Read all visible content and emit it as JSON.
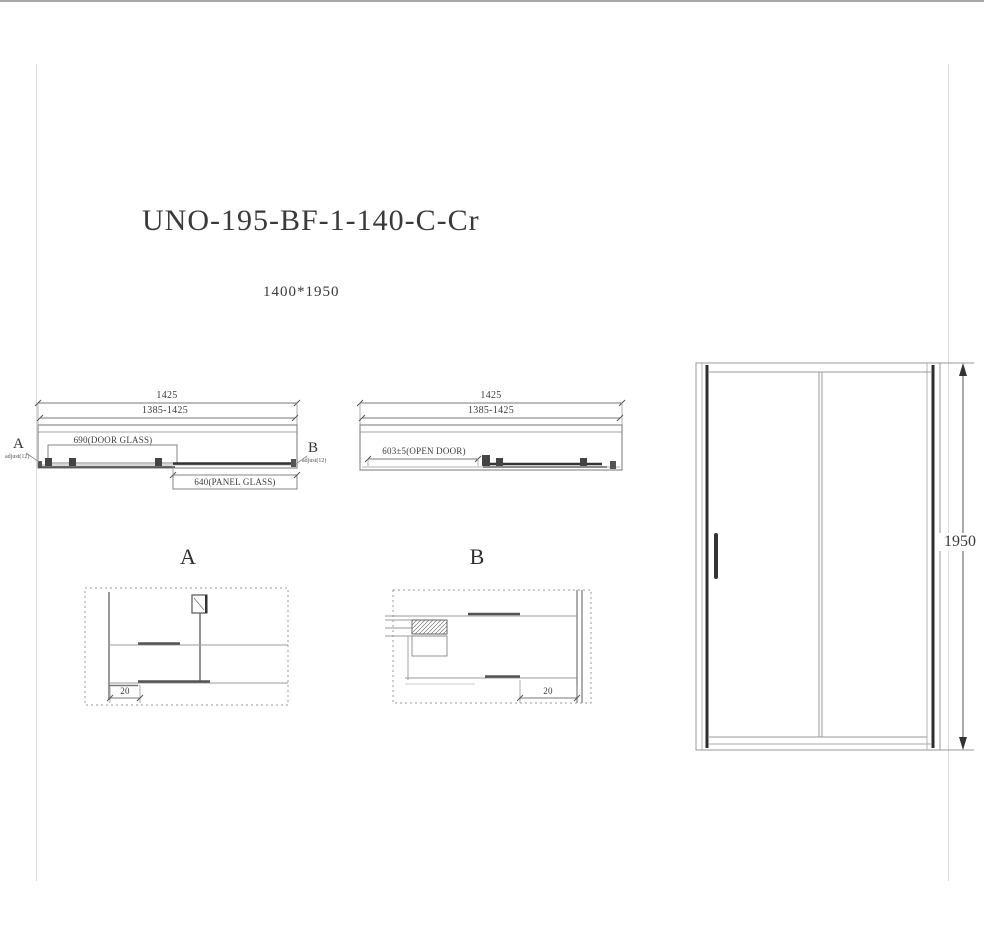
{
  "drawing": {
    "model": "UNO-195-BF-1-140-C-Cr",
    "size": "1400*1950"
  },
  "plan_closed": {
    "dim_overall": "1425",
    "dim_adjust_range": "1385-1425",
    "door_glass": "690(DOOR GLASS)",
    "panel_glass": "640(PANEL GLASS)",
    "marker_a": "A",
    "marker_a_note": "adjust(12)",
    "marker_b": "B",
    "marker_b_note": "adjust(12)"
  },
  "plan_open": {
    "dim_overall": "1425",
    "dim_adjust_range": "1385-1425",
    "open_door": "603±5(OPEN DOOR)"
  },
  "detail_a": {
    "label": "A",
    "dim_offset": "20"
  },
  "detail_b": {
    "label": "B",
    "dim_offset": "20"
  },
  "elevation": {
    "dim_height": "1950"
  }
}
